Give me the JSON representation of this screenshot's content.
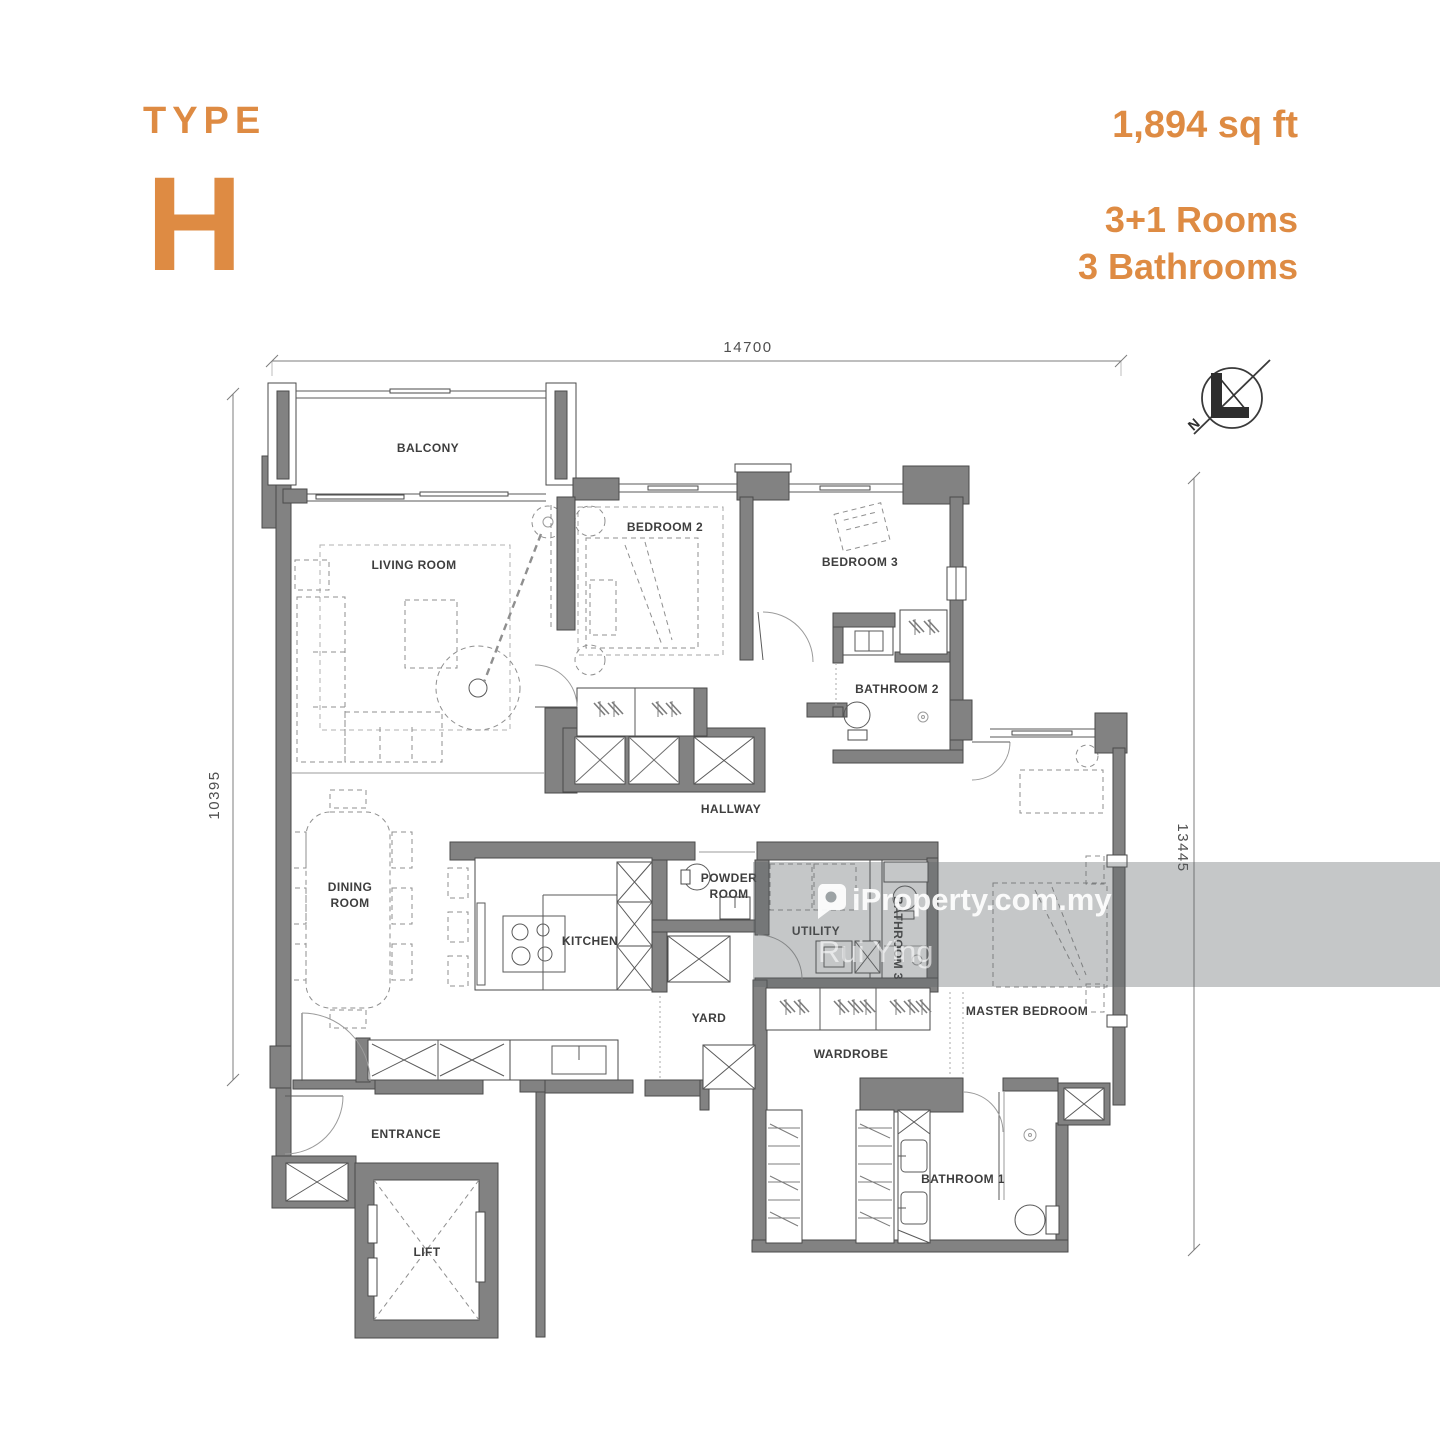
{
  "header": {
    "type_label": "TYPE",
    "type_value": "H",
    "area": "1,894 sq ft",
    "rooms": "3+1 Rooms",
    "bathrooms": "3 Bathrooms"
  },
  "dimensions": {
    "top": "14700",
    "left": "10395",
    "right": "13445"
  },
  "compass": {
    "north": "N"
  },
  "rooms": {
    "balcony": "BALCONY",
    "living": "LIVING ROOM",
    "bedroom2": "BEDROOM 2",
    "bedroom3": "BEDROOM 3",
    "bathroom2": "BATHROOM 2",
    "hallway": "HALLWAY",
    "dining_l1": "DINING",
    "dining_l2": "ROOM",
    "kitchen": "KITCHEN",
    "powder_l1": "POWDER",
    "powder_l2": "ROOM",
    "utility": "UTILITY",
    "bathroom3": "BATHROOM 3",
    "master": "MASTER BEDROOM",
    "yard": "YARD",
    "wardrobe": "WARDROBE",
    "entrance": "ENTRANCE",
    "lift": "LIFT",
    "bathroom1": "BATHROOM 1"
  },
  "watermark": {
    "brand": "iProperty.com.my",
    "agent": "Rui Ying"
  },
  "colors": {
    "accent": "#DE8B43",
    "wall": "#828282",
    "line": "#4a4a4a",
    "label": "#3e3e3e",
    "watermark_band": "#5f6467"
  }
}
